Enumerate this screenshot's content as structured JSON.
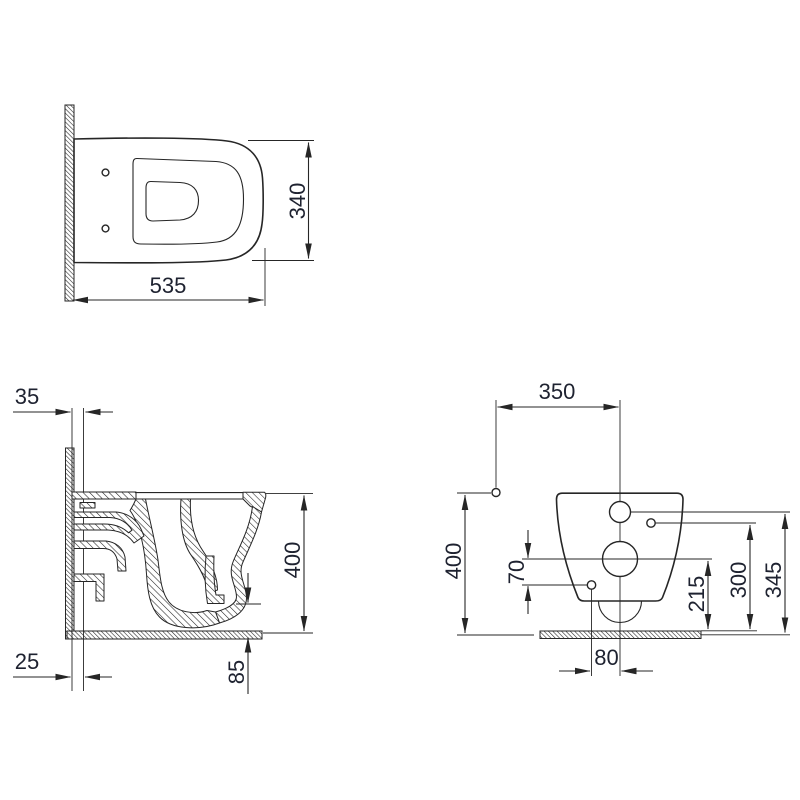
{
  "colors": {
    "background": "#ffffff",
    "line": "#262626",
    "text": "#1e2230"
  },
  "top_view": {
    "width_label": "535",
    "depth_label": "340"
  },
  "side_view": {
    "wall_offset_top_label": "35",
    "wall_offset_bottom_label": "25",
    "height_label": "400",
    "outlet_bottom_label": "85"
  },
  "front_view": {
    "fixing_width_label": "350",
    "height_label": "400",
    "hole_spacing_label": "70",
    "drain_center_height_label": "215",
    "side_hole_height_label": "300",
    "inlet_height_label": "345",
    "hole_offset_label": "80"
  }
}
